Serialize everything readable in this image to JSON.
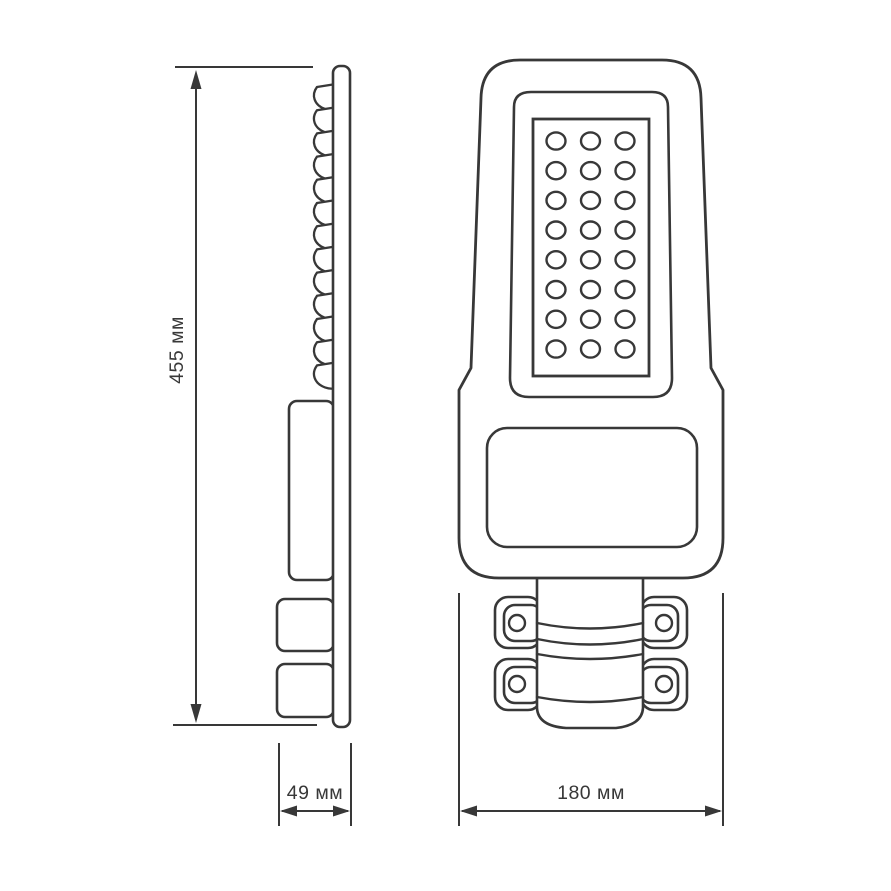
{
  "title": "Street light luminaire dimension drawing",
  "dimensions": {
    "height_label": "455 мм",
    "depth_label": "49 мм",
    "width_label": "180 мм"
  },
  "drawing": {
    "line_color": "#383838",
    "background_color": "#ffffff",
    "led_grid": {
      "rows": 8,
      "columns": 3
    },
    "fins_count": 13
  }
}
